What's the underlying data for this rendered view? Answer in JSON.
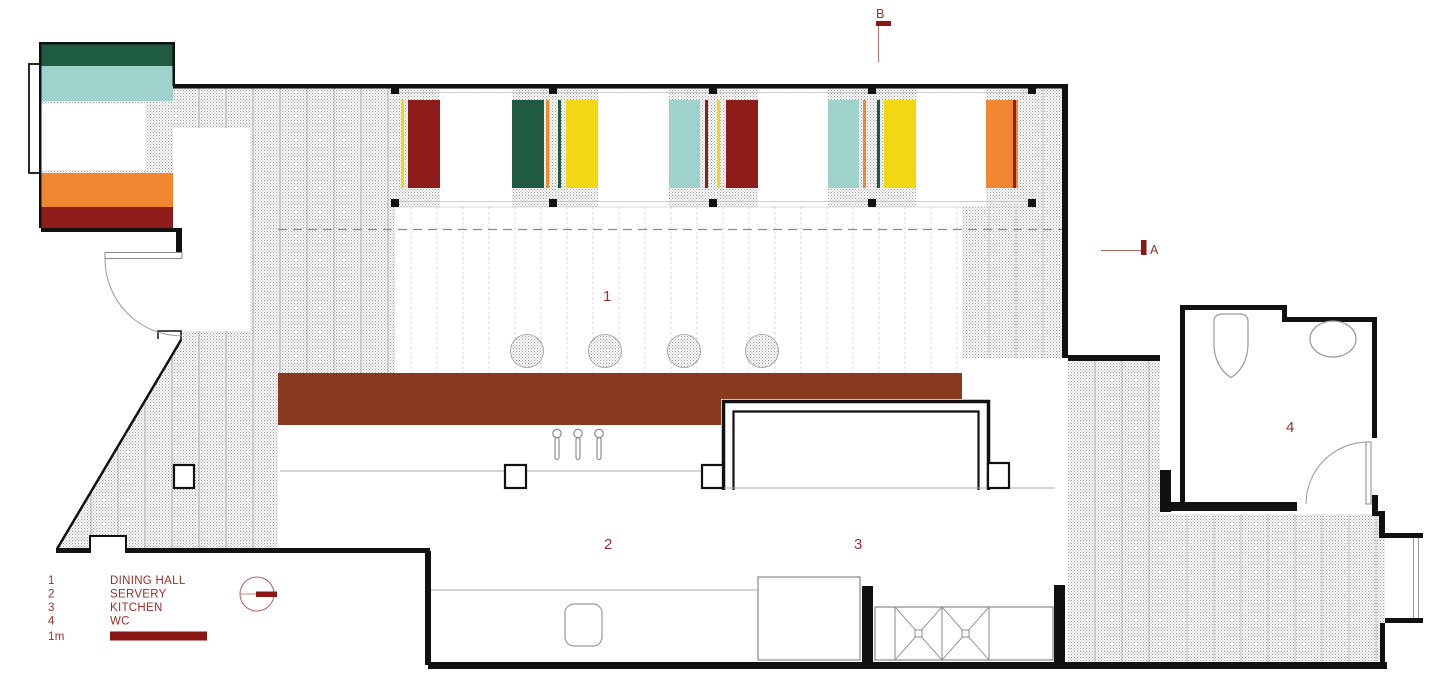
{
  "labels": {
    "room_1": "1",
    "room_2": "2",
    "room_3": "3",
    "room_4": "4",
    "section_a": "A",
    "section_b": "B"
  },
  "legend": {
    "items": [
      {
        "num": "1",
        "label": "DINING HALL"
      },
      {
        "num": "2",
        "label": "SERVERY"
      },
      {
        "num": "3",
        "label": "KITCHEN"
      },
      {
        "num": "4",
        "label": "WC"
      }
    ],
    "scale_label": "1m"
  },
  "palette": {
    "maroon": "#8e1c1a",
    "green": "#1e5b41",
    "teal": "#9fd1cd",
    "yellow": "#f2d713",
    "orange": "#f28732",
    "counter_brown": "#873a1e",
    "marker_red": "#8a1713",
    "text_red": "#9e2f28",
    "thin_red": "#b06058",
    "wall_black": "#111111",
    "hatch_dot": "#9a9a9a"
  },
  "tables_sequence": [
    "maroon",
    "green",
    "yellow",
    "teal",
    "maroon",
    "teal",
    "yellow",
    "orange"
  ]
}
